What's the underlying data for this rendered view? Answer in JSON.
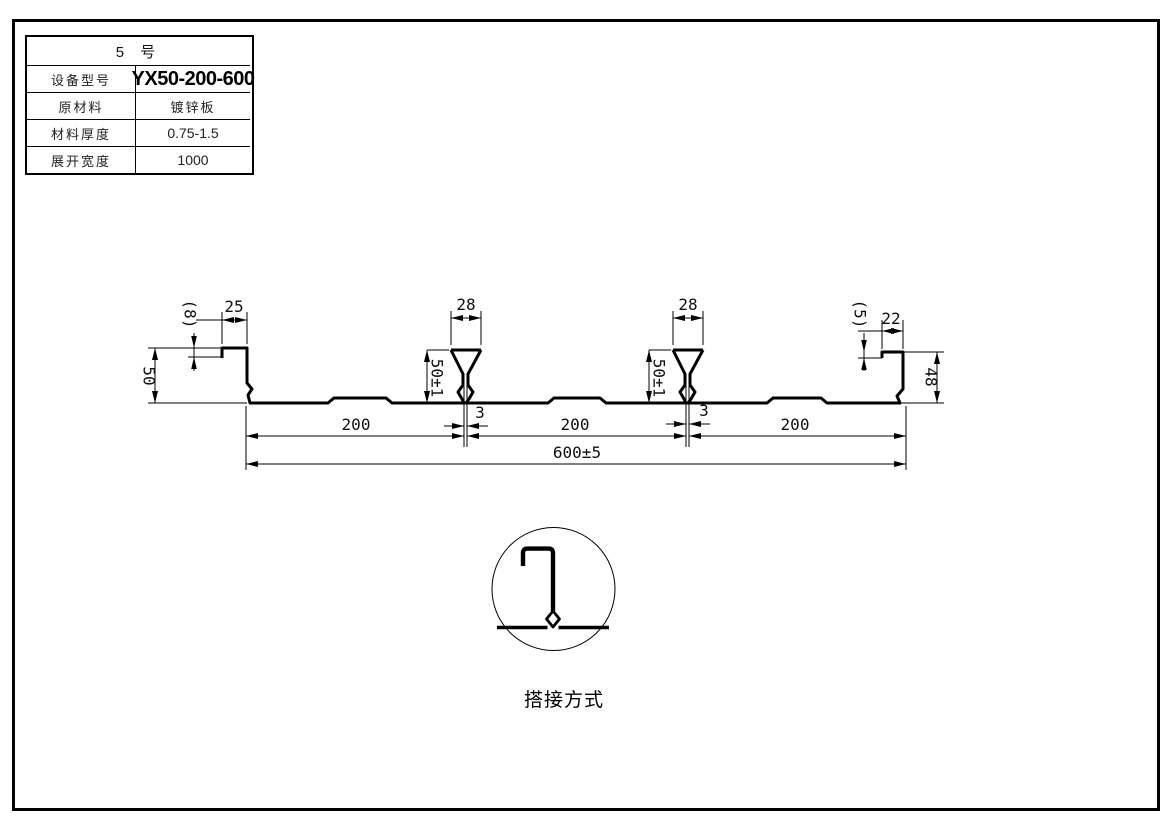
{
  "table": {
    "title": "5  号",
    "rows": [
      {
        "label": "设备型号",
        "value": "YX50-200-600"
      },
      {
        "label": "原材料",
        "value": "镀锌板"
      },
      {
        "label": "材料厚度",
        "value": "0.75-1.5"
      },
      {
        "label": "展开宽度",
        "value": "1000"
      }
    ]
  },
  "dims": {
    "left_lip": "(8)",
    "left_flange": "25",
    "left_height": "50",
    "rib_width": "28",
    "rib_height": "50±1",
    "seam_gap": "3",
    "right_lip": "(5)",
    "right_flange": "22",
    "right_height": "48",
    "pitch": "200",
    "overall": "600±5"
  },
  "detail": {
    "caption": "搭接方式"
  },
  "colors": {
    "line": "#000000",
    "background": "#ffffff"
  }
}
